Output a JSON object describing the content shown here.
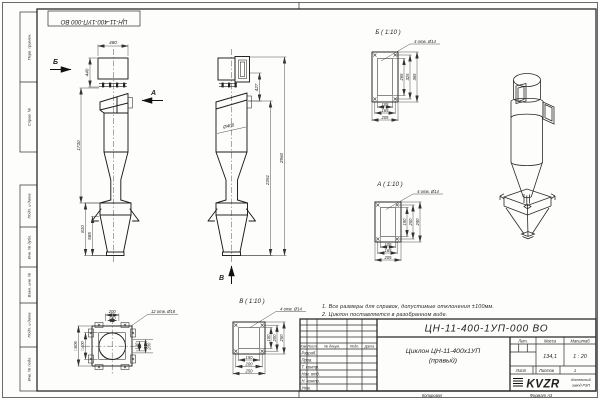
{
  "sheet": {
    "stamp_top": "ЦН-11-400-1УП-000 ВО",
    "copied_label": "Копировал",
    "format_label": "Формат А3",
    "left_top": [
      "Перв. примен.",
      "Справ. №"
    ],
    "left_bottom": [
      "Подп. и дата",
      "Инв. № дубл.",
      "Взам. инв. №",
      "Подп. и дата",
      "Инв. № подл."
    ]
  },
  "views": {
    "front": {
      "view_b": "Б",
      "view_a": "А",
      "dim_480": "480",
      "dim_440": "440",
      "dim_1730": "1730",
      "dim_810": "810",
      "dim_585": "585"
    },
    "side": {
      "dim_427": "427",
      "dim_diam": "Ø400",
      "dim_2351": "2351",
      "dim_2960": "2960",
      "view_v": "В"
    },
    "plan": {
      "dim_200": "200",
      "dim_140": "140",
      "holes": "12 отв. Ø18",
      "dim_r140": "140",
      "dim_r200": "200",
      "sq_outer": "□606",
      "sq_inner": "□400"
    }
  },
  "details": {
    "b": {
      "title": "Б ( 1:10 )",
      "holes": "4 отв. Ø14",
      "v": [
        "265",
        "325",
        "365"
      ],
      "h": [
        "105",
        "165",
        "205"
      ]
    },
    "a": {
      "title": "А ( 1:10 )",
      "holes": "4 отв. Ø14",
      "v": [
        "190",
        "250",
        "290"
      ],
      "h": [
        "105",
        "165",
        "205"
      ]
    },
    "v": {
      "title": "В ( 1:10 )",
      "holes": "4 отв. Ø14",
      "v": [
        "150",
        "200",
        "250"
      ],
      "h": [
        "150",
        "200",
        "250"
      ]
    }
  },
  "notes": [
    "1. Все размеры для справок, допустимые отклонения ±100мм.",
    "2. Циклон поставляется в разобранном виде."
  ],
  "title_block": {
    "doc_number": "ЦН-11-400-1УП-000 ВО",
    "title_line1": "Циклон ЦН-11-400х1УП",
    "title_line2": "(правый)",
    "header_cols": [
      "Изм.",
      "Лист",
      "№ докум.",
      "Подп.",
      "Дата"
    ],
    "row_labels": [
      "Разраб.",
      "Пров.",
      "Т. контр.",
      "Нач. отд.",
      "Н. контр.",
      "Утв."
    ],
    "lit_label": "Лит.",
    "mass_label": "Масса",
    "scale_label": "Масштаб",
    "mass_value": "134,1",
    "scale_value": "1 : 20",
    "sheet_label": "Лист",
    "sheets_label": "Листов",
    "sheets_value": "1",
    "company_logo": "KVZR",
    "company_name_1": "Котельный",
    "company_name_2": "завод РЭП"
  }
}
